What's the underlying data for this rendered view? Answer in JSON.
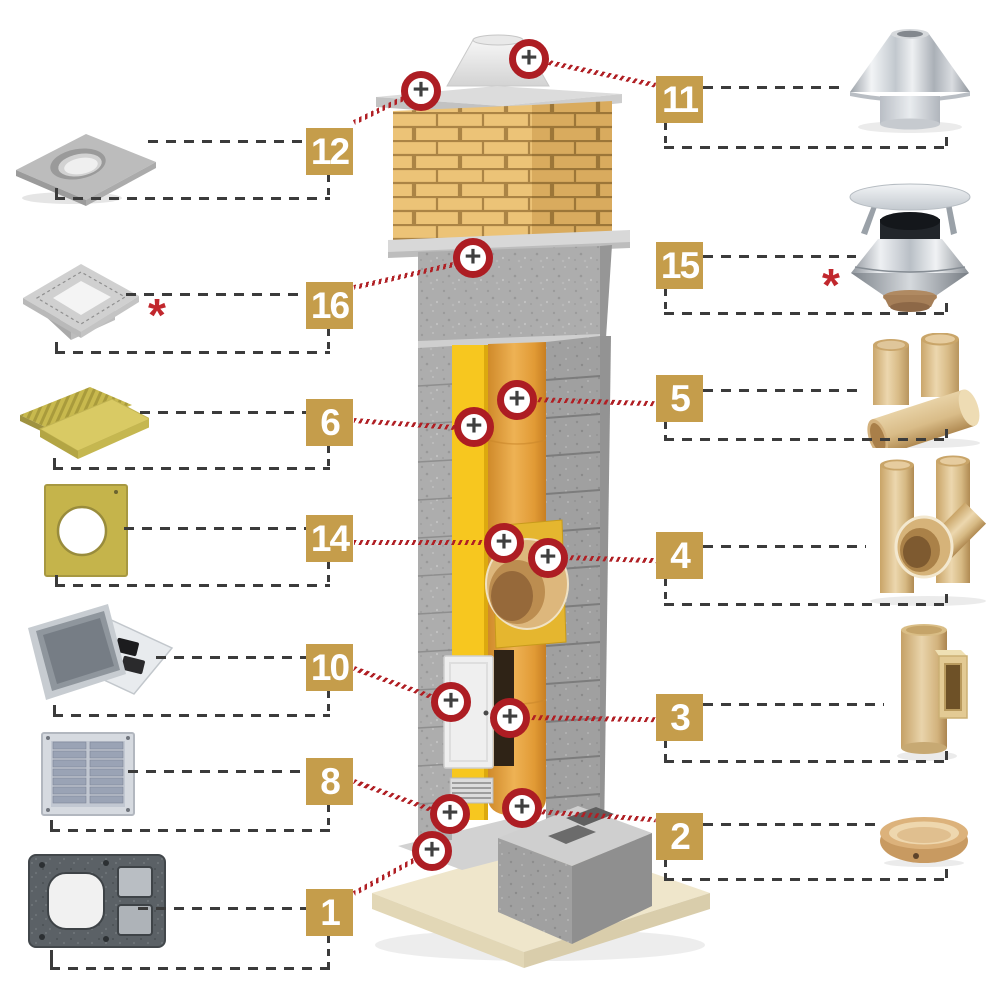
{
  "title": "Ceramic chimney system components diagram",
  "symbols": {
    "plus": "+",
    "asterisk": "*"
  },
  "colors": {
    "label_gold": "#c59d4b",
    "marker_ring_red": "#ad1d23",
    "link_line_red": "#b01f24",
    "dash_dark": "#3b3b3b",
    "asterisk_red": "#c1272d",
    "brick_yellow": "#ecc377",
    "insulation_yellow": "#f7c71f",
    "liner_orange": "#e8a43c",
    "ceramic_beige": "#d9bc88",
    "base_slab_beige": "#efe6cb"
  },
  "items": [
    {
      "number": "12",
      "side": "left",
      "product": "cover-slab-with-hole",
      "has_asterisk": false
    },
    {
      "number": "16",
      "side": "left",
      "product": "sloped-top-form",
      "has_asterisk": true
    },
    {
      "number": "6",
      "side": "left",
      "product": "insulation-boards",
      "has_asterisk": false
    },
    {
      "number": "14",
      "side": "left",
      "product": "wool-plate-with-hole",
      "has_asterisk": false
    },
    {
      "number": "10",
      "side": "left",
      "product": "inspection-door",
      "has_asterisk": false
    },
    {
      "number": "8",
      "side": "left",
      "product": "ventilation-grille",
      "has_asterisk": false
    },
    {
      "number": "1",
      "side": "left",
      "product": "chimney-block",
      "has_asterisk": false
    },
    {
      "number": "11",
      "side": "right",
      "product": "stainless-chimney-cap",
      "has_asterisk": false
    },
    {
      "number": "15",
      "side": "right",
      "product": "cone-cap-with-plate",
      "has_asterisk": true
    },
    {
      "number": "5",
      "side": "right",
      "product": "ceramic-pipe-segments",
      "has_asterisk": false
    },
    {
      "number": "4",
      "side": "right",
      "product": "ceramic-tee-45",
      "has_asterisk": false
    },
    {
      "number": "3",
      "side": "right",
      "product": "ceramic-inspection-pipe",
      "has_asterisk": false
    },
    {
      "number": "2",
      "side": "right",
      "product": "condensate-bowl",
      "has_asterisk": false
    }
  ],
  "markers": [
    {
      "links_to": "11"
    },
    {
      "links_to": "12"
    },
    {
      "links_to": "16"
    },
    {
      "links_to": "5"
    },
    {
      "links_to": "6"
    },
    {
      "links_to": "14"
    },
    {
      "links_to": "4"
    },
    {
      "links_to": "10"
    },
    {
      "links_to": "3"
    },
    {
      "links_to": "8"
    },
    {
      "links_to": "2"
    },
    {
      "links_to": "1"
    }
  ]
}
